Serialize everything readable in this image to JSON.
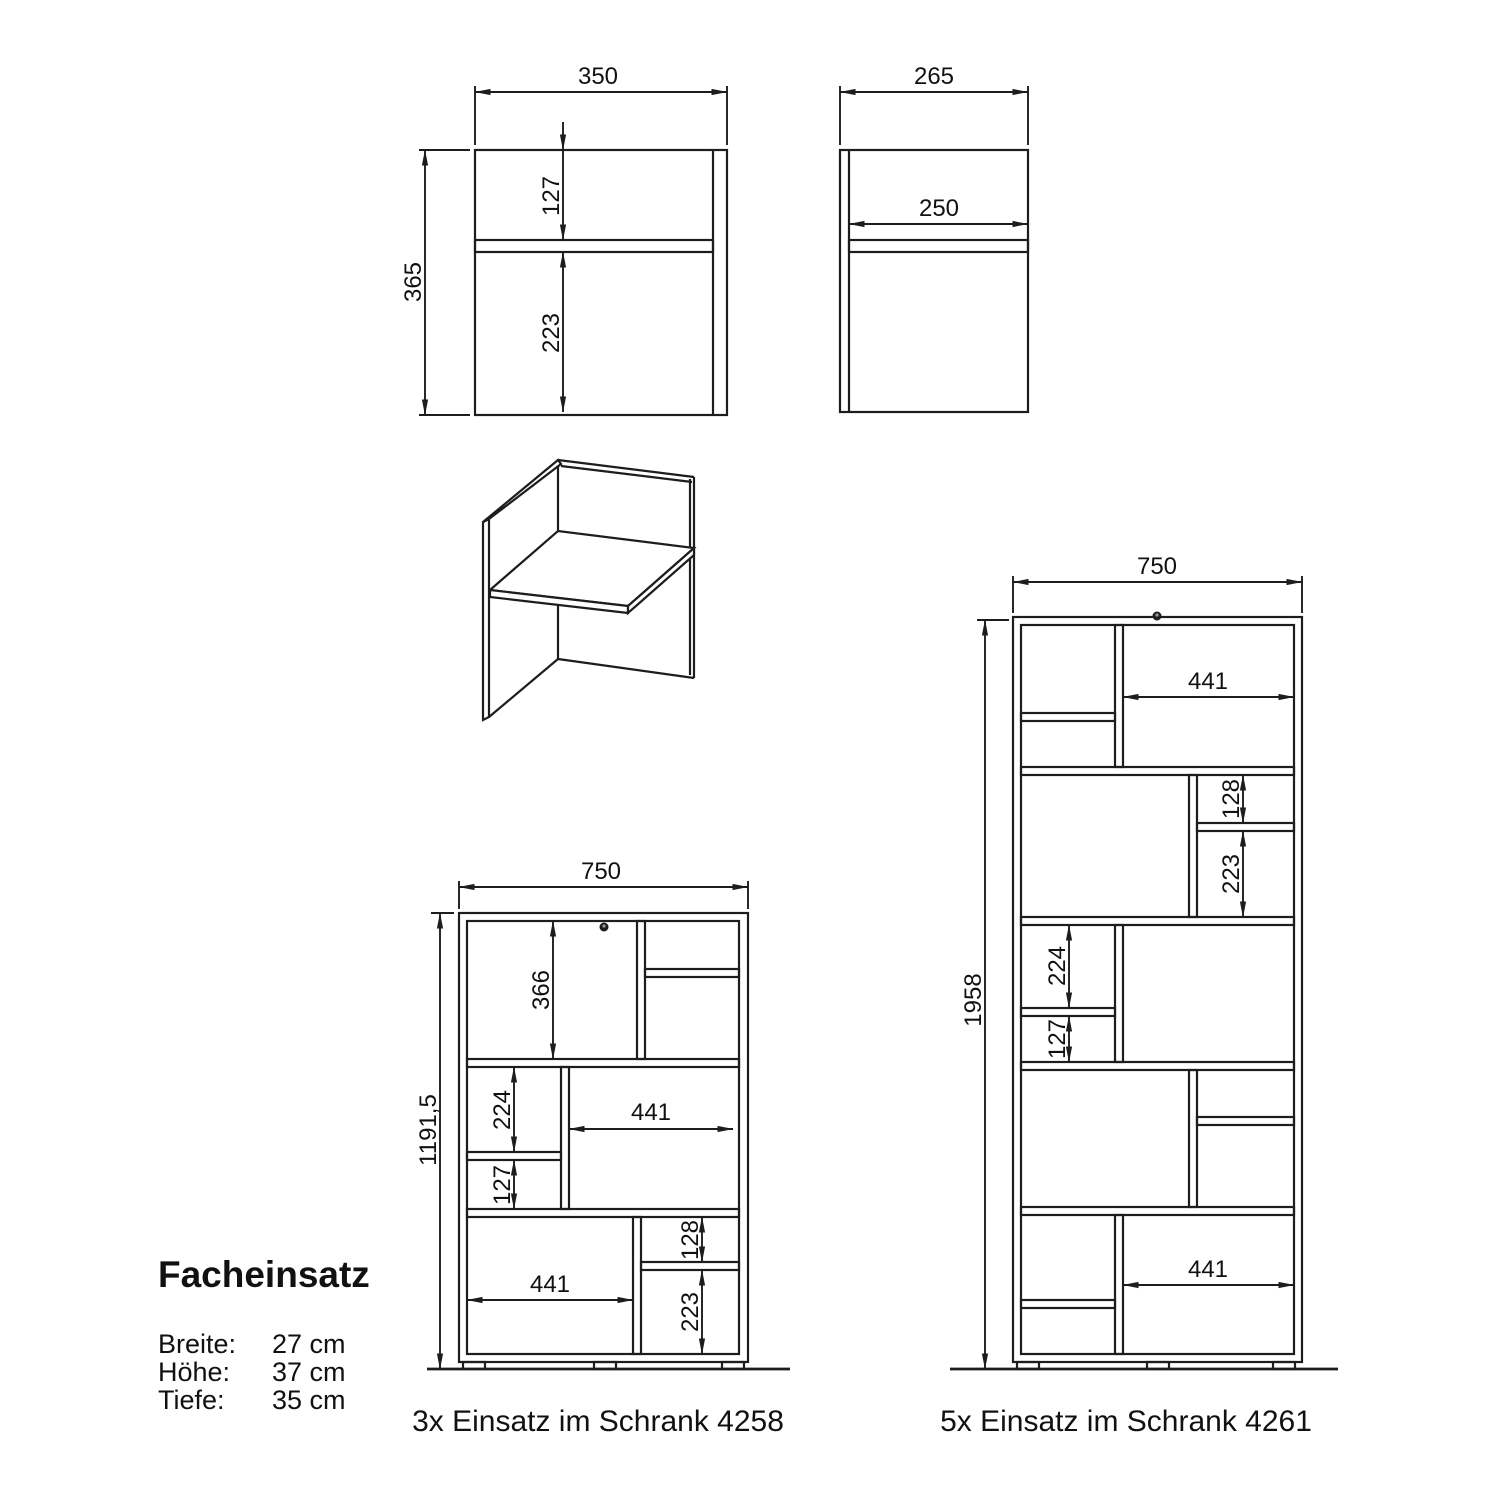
{
  "front_view": {
    "width_mm": "350",
    "height_mm": "365",
    "top_compartment_mm": "127",
    "bottom_compartment_mm": "223"
  },
  "side_view": {
    "depth_mm": "265",
    "shelf_depth_mm": "250"
  },
  "cabinet_4258": {
    "caption": "3x Einsatz im Schrank 4258",
    "width_mm": "750",
    "height_mm": "1191,5",
    "top_left_compartment_mm": "366",
    "middle_left_upper_mm": "224",
    "middle_left_lower_mm": "127",
    "middle_right_width_mm": "441",
    "bottom_left_width_mm": "441",
    "bottom_right_upper_mm": "128",
    "bottom_right_lower_mm": "223"
  },
  "cabinet_4261": {
    "caption": "5x Einsatz im Schrank 4261",
    "width_mm": "750",
    "height_mm": "1958",
    "top_right_width_mm": "441",
    "upper_right_upper_mm": "128",
    "upper_right_lower_mm": "223",
    "middle_left_upper_mm": "224",
    "middle_left_lower_mm": "127",
    "bottom_right_width_mm": "441"
  },
  "info_panel": {
    "title": "Facheinsatz",
    "specs": [
      {
        "label": "Breite:",
        "value": "27 cm"
      },
      {
        "label": "Höhe:",
        "value": "37 cm"
      },
      {
        "label": "Tiefe:",
        "value": "35 cm"
      }
    ]
  }
}
